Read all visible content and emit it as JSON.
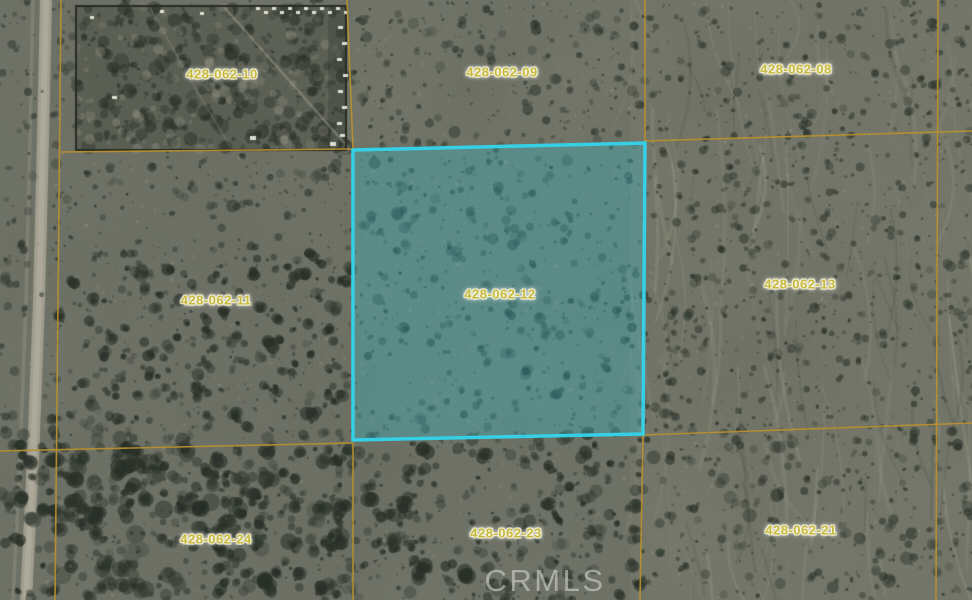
{
  "map": {
    "watermark": "CRMLS",
    "colors": {
      "boundary_line": "#b8902f",
      "highlight_stroke": "#35d0e6",
      "highlight_fill": "rgba(53,200,216,0.30)",
      "label_text": "#c6ba3e",
      "label_halo": "#f7f3dc"
    },
    "highlighted_parcel": {
      "apn": "428-062-12",
      "polygon_points": "353,150 645,143 643,434 353,440"
    },
    "parcel_labels": [
      {
        "apn": "428-062-10",
        "x": 222,
        "y": 74,
        "highlighted": false
      },
      {
        "apn": "428-062-09",
        "x": 502,
        "y": 72,
        "highlighted": false
      },
      {
        "apn": "428-062-08",
        "x": 796,
        "y": 69,
        "highlighted": false
      },
      {
        "apn": "428-062-11",
        "x": 216,
        "y": 300,
        "highlighted": false
      },
      {
        "apn": "428-062-12",
        "x": 500,
        "y": 294,
        "highlighted": true
      },
      {
        "apn": "428-062-13",
        "x": 800,
        "y": 284,
        "highlighted": false
      },
      {
        "apn": "428-062-24",
        "x": 216,
        "y": 539,
        "highlighted": false
      },
      {
        "apn": "428-062-23",
        "x": 506,
        "y": 533,
        "highlighted": false
      },
      {
        "apn": "428-062-21",
        "x": 801,
        "y": 530,
        "highlighted": false
      }
    ],
    "boundary_lines": [
      {
        "x1": 61,
        "y1": 0,
        "x2": 55,
        "y2": 600
      },
      {
        "x1": 347,
        "y1": 0,
        "x2": 353,
        "y2": 149
      },
      {
        "x1": 353,
        "y1": 443,
        "x2": 353,
        "y2": 600
      },
      {
        "x1": 645,
        "y1": 0,
        "x2": 645,
        "y2": 142
      },
      {
        "x1": 643,
        "y1": 435,
        "x2": 640,
        "y2": 600
      },
      {
        "x1": 938,
        "y1": 0,
        "x2": 936,
        "y2": 600
      },
      {
        "x1": 61,
        "y1": 152,
        "x2": 353,
        "y2": 149
      },
      {
        "x1": 645,
        "y1": 141,
        "x2": 972,
        "y2": 131
      },
      {
        "x1": 0,
        "y1": 451,
        "x2": 353,
        "y2": 443
      },
      {
        "x1": 643,
        "y1": 435,
        "x2": 972,
        "y2": 423
      }
    ]
  }
}
